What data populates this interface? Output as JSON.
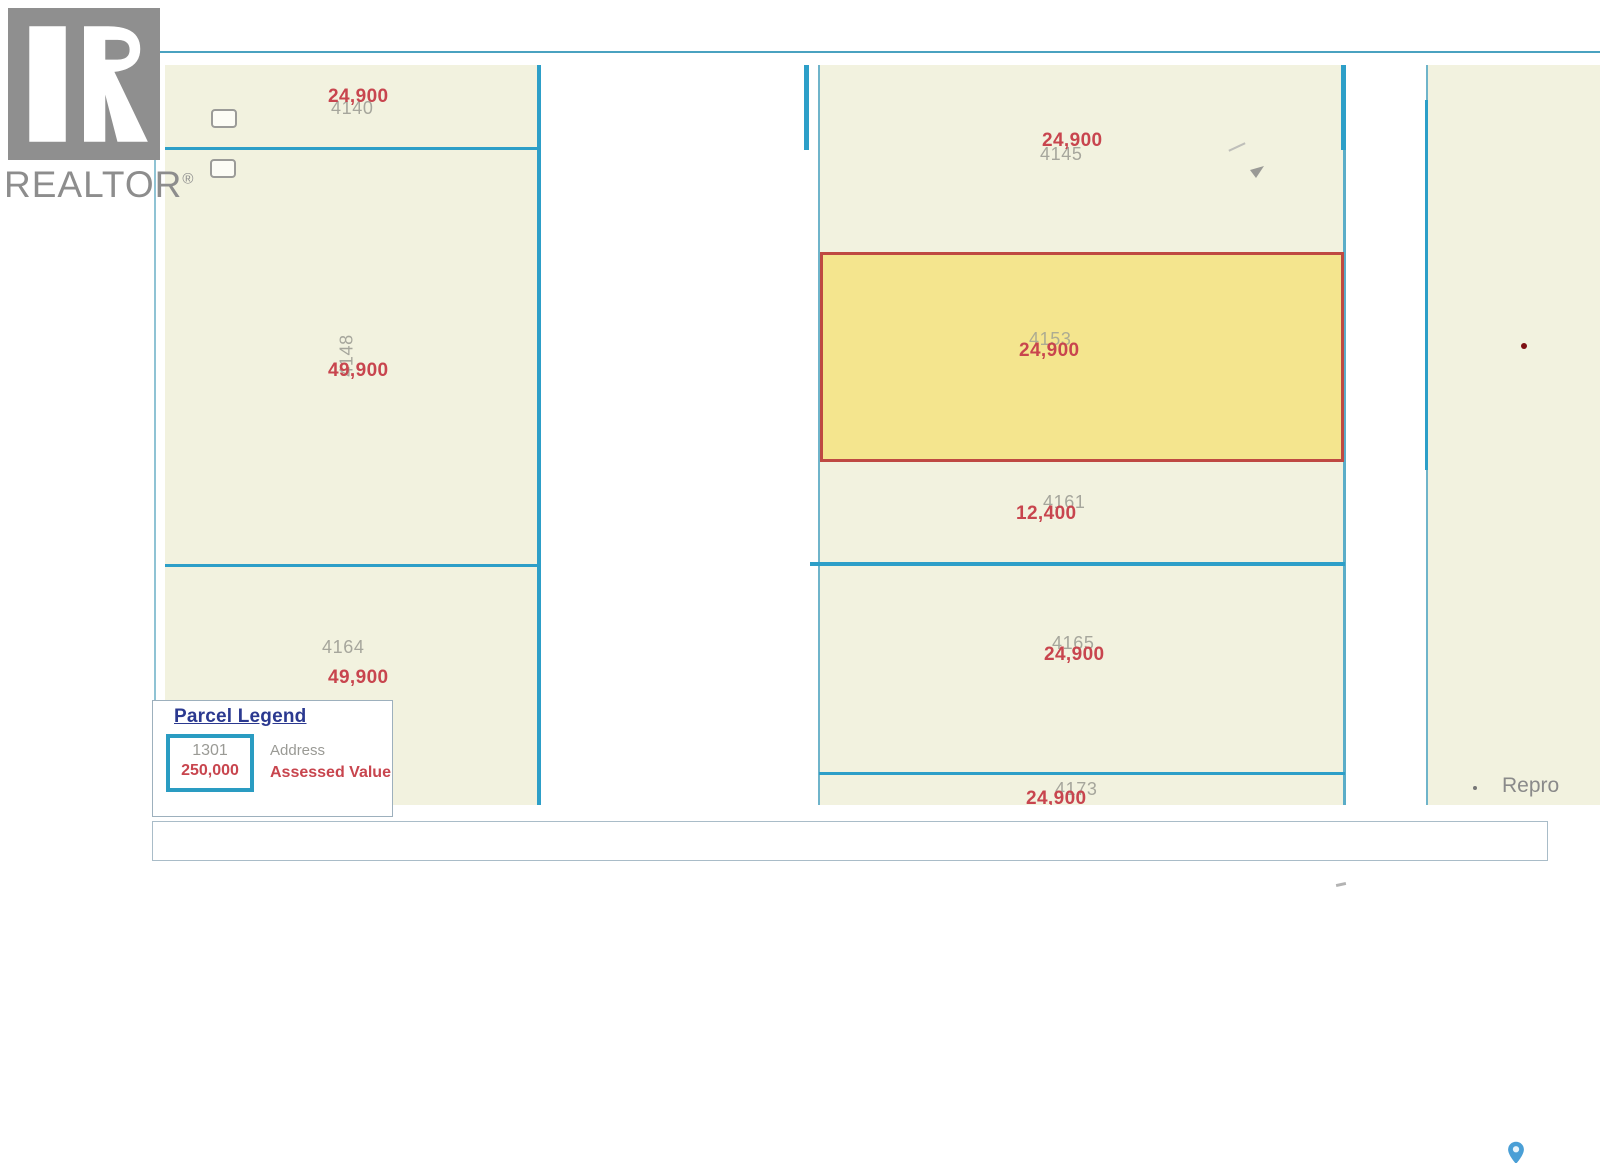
{
  "branding": {
    "logo_text": "REALTOR",
    "registered_mark": "®"
  },
  "map": {
    "parcels": [
      {
        "address": "4140",
        "value": "24,900",
        "highlighted": false
      },
      {
        "address": "4148",
        "value": "49,900",
        "highlighted": false
      },
      {
        "address": "4164",
        "value": "49,900",
        "highlighted": false
      },
      {
        "address": "4145",
        "value": "24,900",
        "highlighted": false
      },
      {
        "address": "4153",
        "value": "24,900",
        "highlighted": true
      },
      {
        "address": "4161",
        "value": "12,400",
        "highlighted": false
      },
      {
        "address": "4165",
        "value": "24,900",
        "highlighted": false
      },
      {
        "address": "4173",
        "value": "24,900",
        "highlighted": false
      }
    ],
    "truncated_note": "Repro"
  },
  "legend": {
    "title": "Parcel Legend",
    "sample_address": "1301",
    "sample_value": "250,000",
    "address_label": "Address",
    "value_label": "Assessed Value"
  },
  "colors": {
    "parcel_fill": "#f2f2df",
    "highlight_fill": "#f4e58e",
    "boundary_blue": "#2d9fc8",
    "highlight_border": "#bf4942",
    "value_red": "#c8454e",
    "address_gray": "#a6a69c",
    "legend_title_navy": "#2b3990",
    "pin_blue": "#4a9fd6"
  }
}
